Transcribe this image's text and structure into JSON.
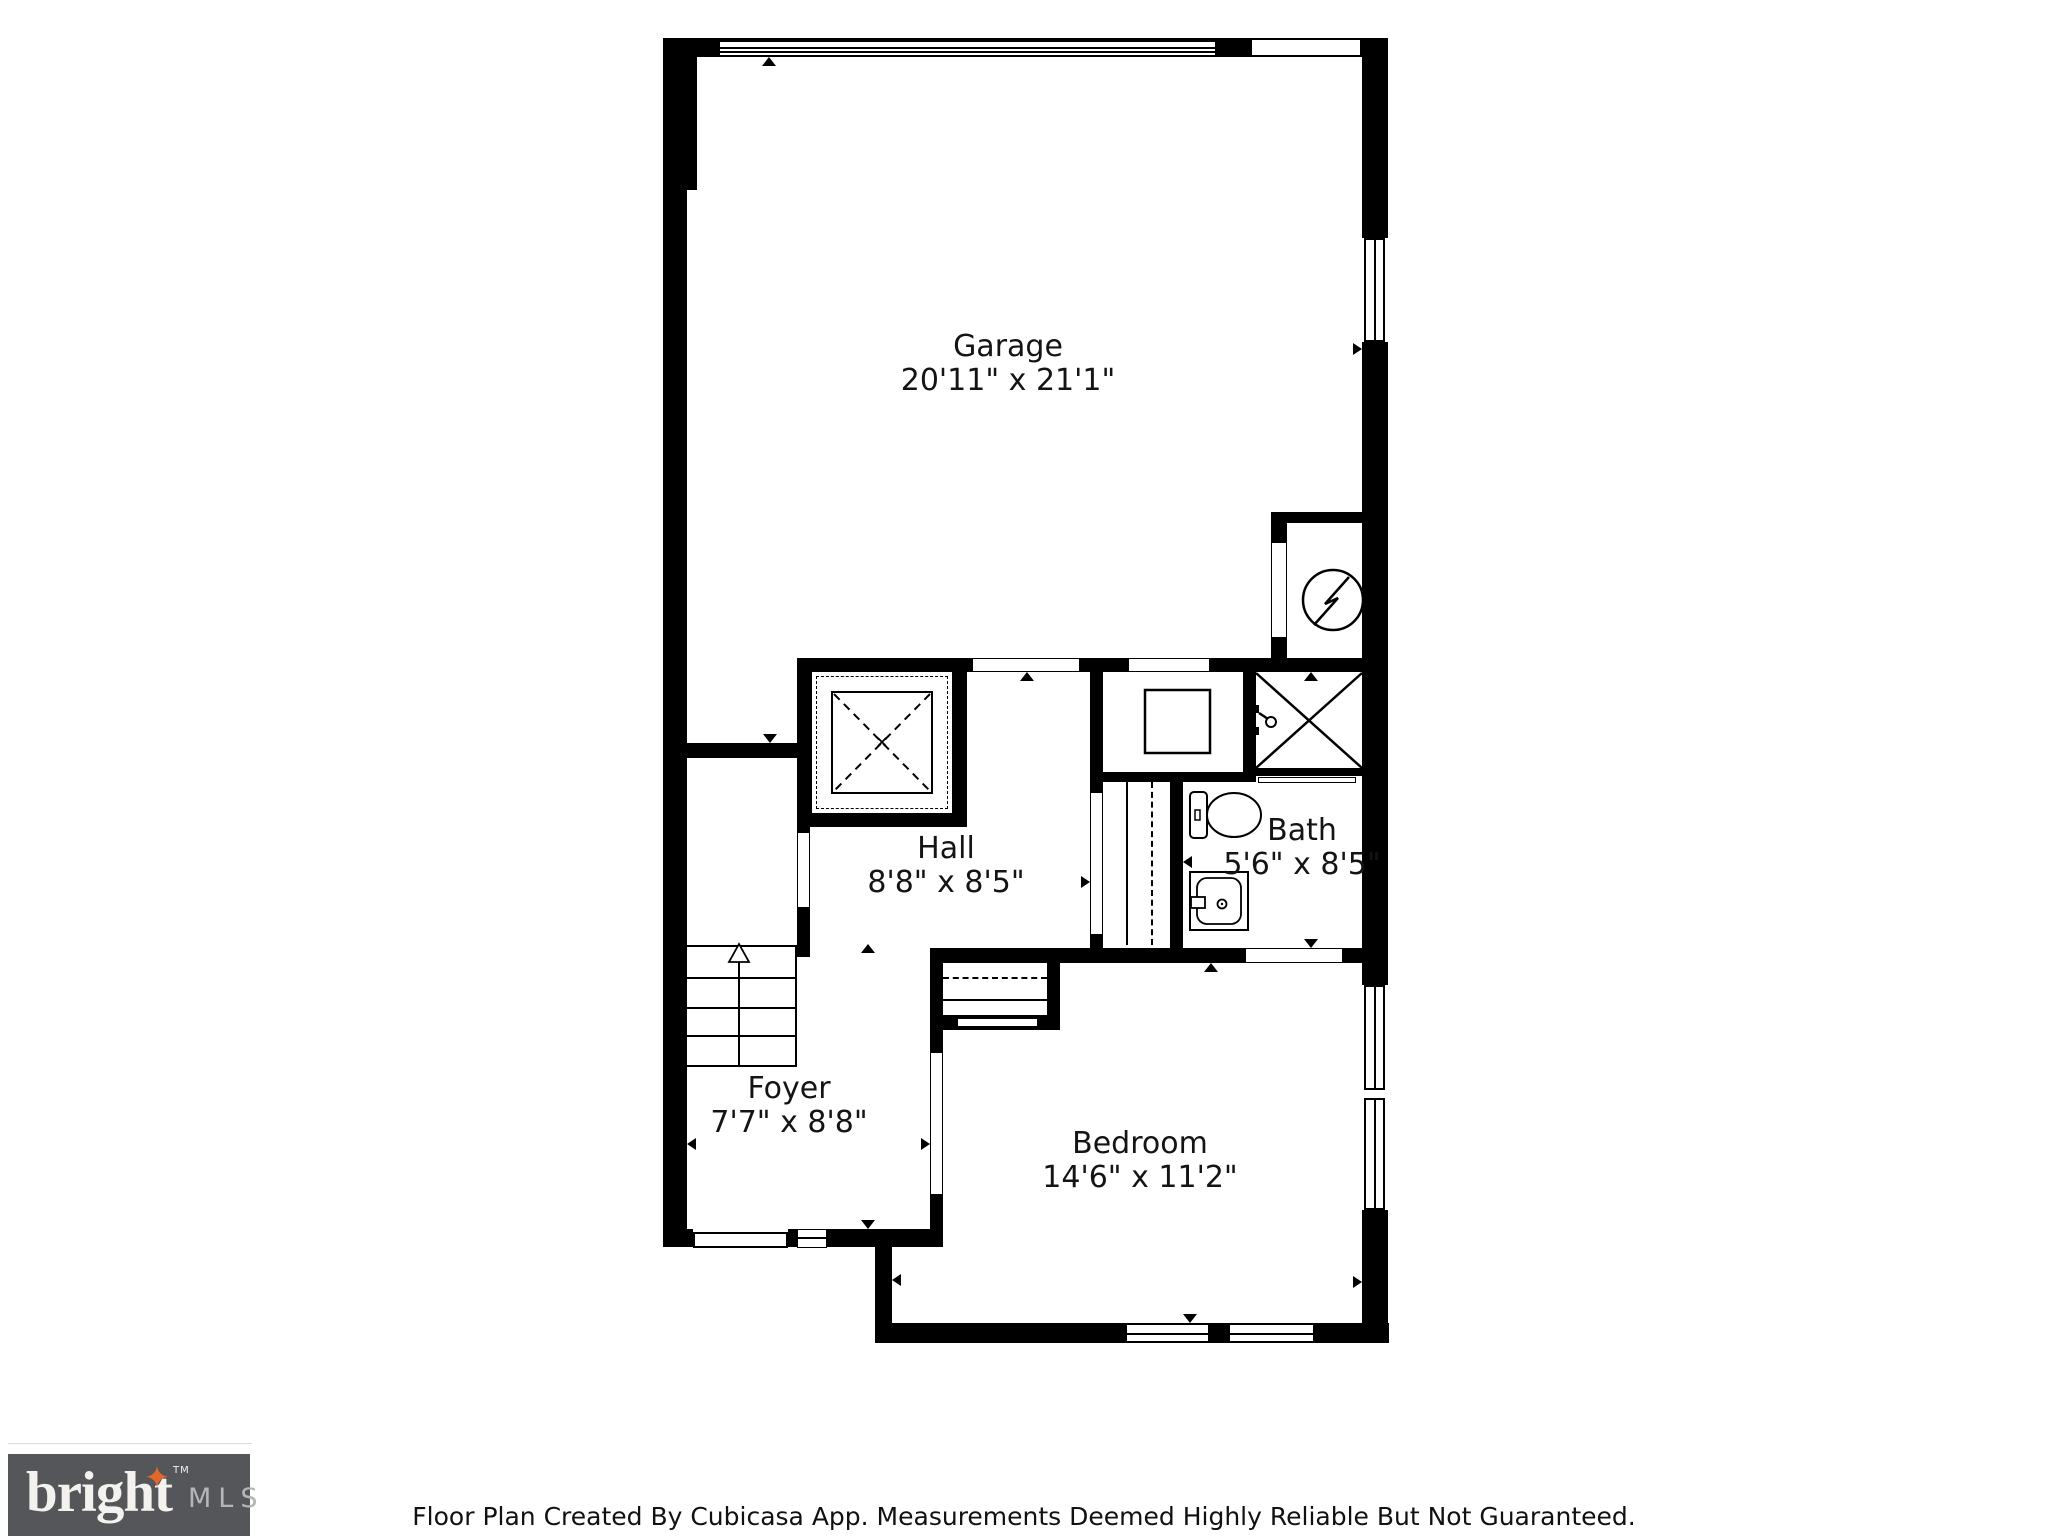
{
  "rooms": [
    {
      "id": "garage",
      "name": "Garage",
      "dims": "20'11\" x 21'1\""
    },
    {
      "id": "hall",
      "name": "Hall",
      "dims": "8'8\" x 8'5\""
    },
    {
      "id": "bath",
      "name": "Bath",
      "dims": "5'6\" x 8'5\""
    },
    {
      "id": "foyer",
      "name": "Foyer",
      "dims": "7'7\" x 8'8\""
    },
    {
      "id": "bedroom",
      "name": "Bedroom",
      "dims": "14'6\" x 11'2\""
    }
  ],
  "footer": {
    "disclaimer": "Floor Plan Created By Cubicasa App. Measurements Deemed Highly Reliable But Not Guaranteed."
  },
  "logo": {
    "brand": "bright",
    "star": "✦",
    "tm": "TM",
    "suffix": "MLS"
  },
  "icons": {
    "stairs": "stairs-up-arrow-icon",
    "shower": "shower-stall-x-icon",
    "electrical": "electrical-panel-lightning-icon",
    "appliance": "washer-box-icon",
    "toilet": "toilet-icon",
    "vanity": "sink-vanity-icon",
    "void_box": "dashed-x-box-icon"
  },
  "colors": {
    "wall": "#000000",
    "text": "#141414",
    "logo_bg": "#54565a",
    "logo_brand": "#f4f2ef",
    "logo_mls": "#b4b6b8",
    "logo_star": "#e2672a"
  }
}
